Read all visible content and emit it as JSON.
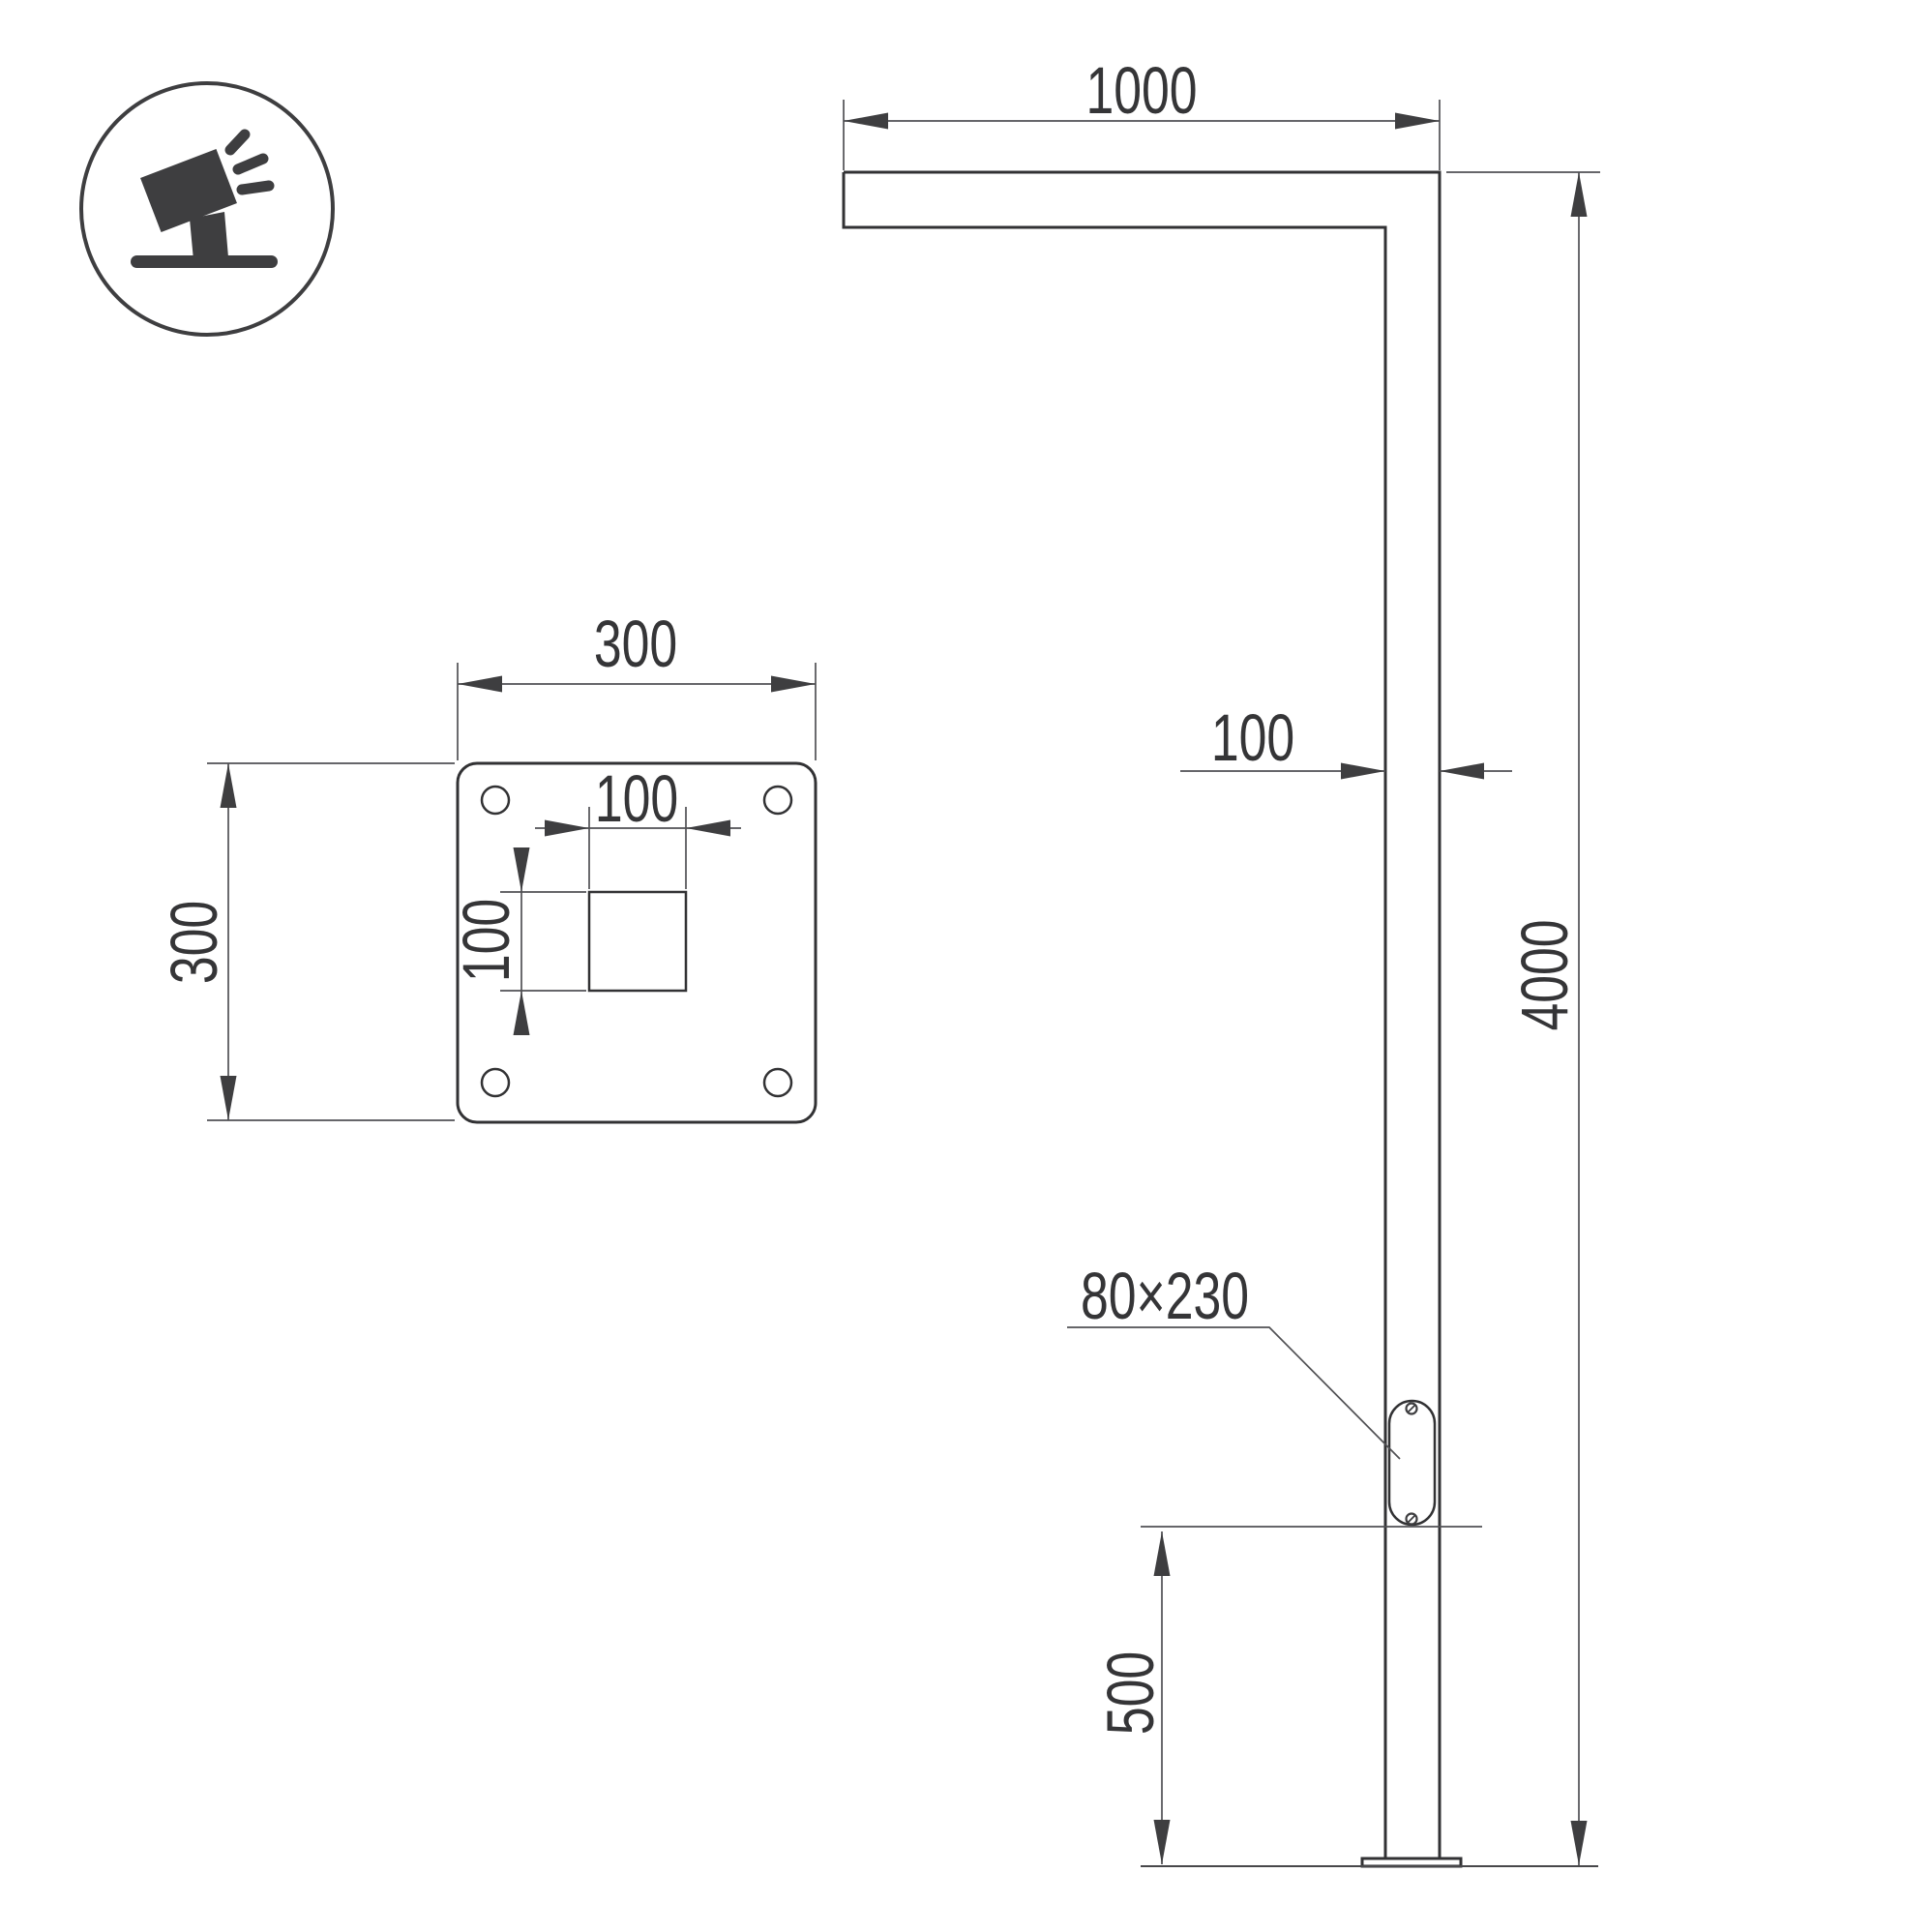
{
  "drawing": {
    "background_color": "#ffffff",
    "object_line_color": "#323234",
    "dimension_line_color": "#515154",
    "text_color": "#353537",
    "icon": {
      "name": "floodlight-on-stand",
      "color": "#3e3e40"
    },
    "elevation": {
      "arm_length_label": "1000",
      "pole_width_label": "100",
      "height_label": "4000",
      "hatch_size_label": "80×230",
      "hatch_height_label": "500"
    },
    "base_plate": {
      "width_label": "300",
      "height_label": "300",
      "cutout_width_label": "100",
      "cutout_height_label": "100"
    }
  }
}
